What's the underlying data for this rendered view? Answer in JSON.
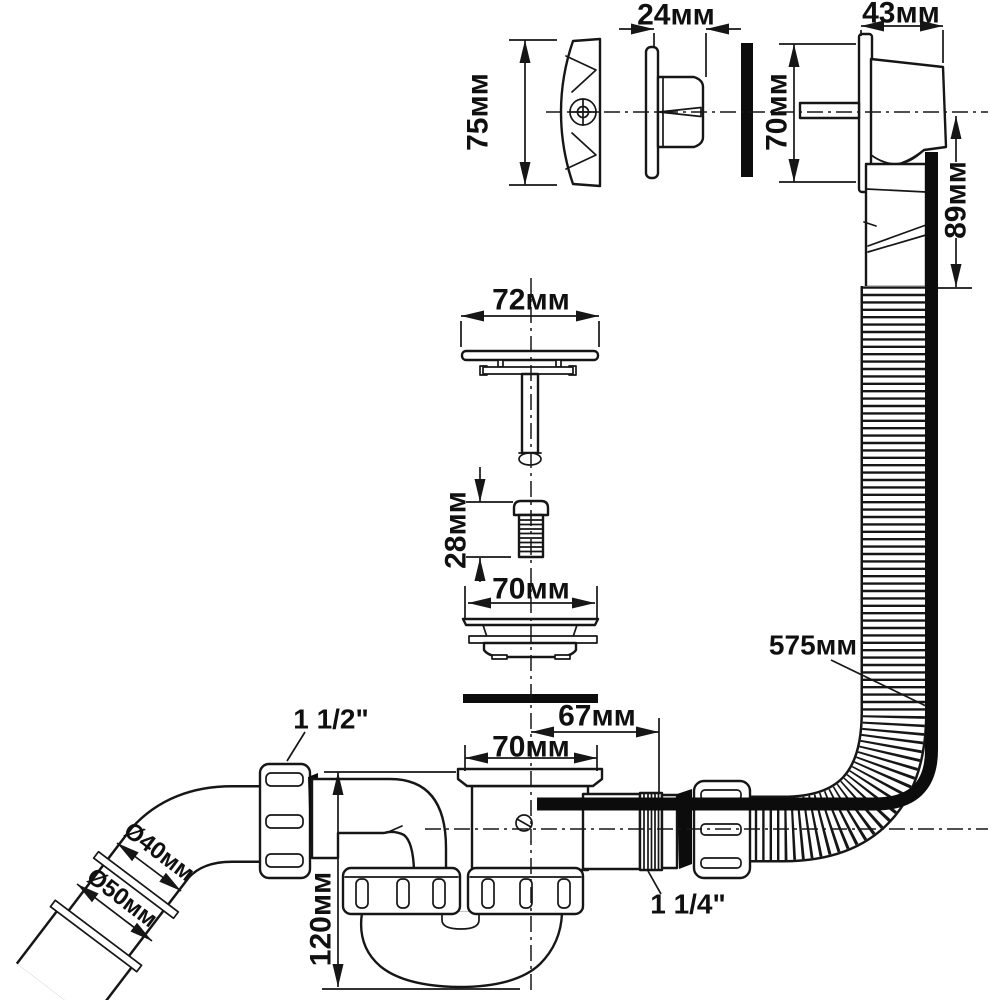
{
  "drawing": {
    "dims": {
      "cap_height": "75мм",
      "flange_depth": "24мм",
      "housing_width": "43мм",
      "faceplate_height": "70мм",
      "tail_length": "89мм",
      "plug_width": "72мм",
      "bolt_length": "28мм",
      "strainer_width": "70мм",
      "hose_length": "575мм",
      "outlet_offset": "67мм",
      "inlet_width": "70мм",
      "pipe_diameter": "Ø40мм",
      "socket_diameter": "Ø50мм",
      "trap_depth": "120мм",
      "inlet_thread": "1 1/2\"",
      "overflow_thread": "1 1/4\""
    }
  }
}
